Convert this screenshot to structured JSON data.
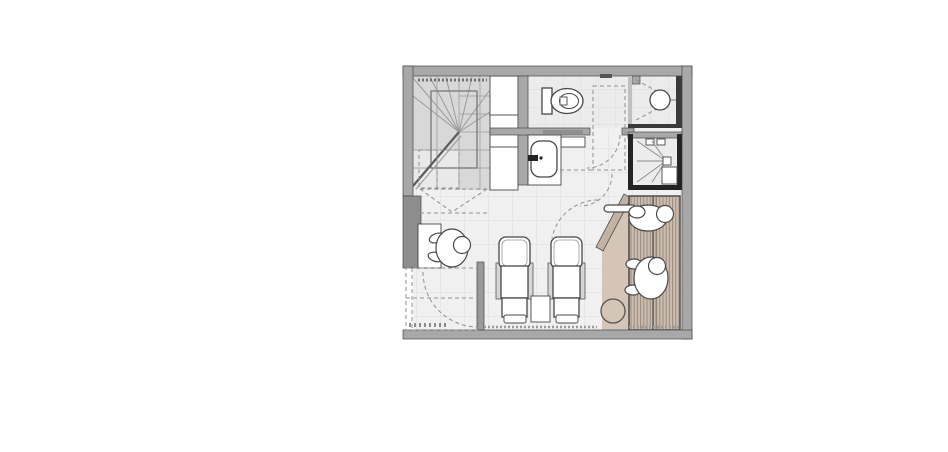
{
  "meta": {
    "document_type": "architectural-floor-plan",
    "view": "top-down plan view",
    "visible_text": ""
  },
  "colors": {
    "canvas": "#ffffff",
    "wall": "#a8a8a8",
    "wall_dark": "#8d8d8d",
    "wall_black": "#242424",
    "outline": "#474747",
    "floor": "#f0f0f0",
    "room_floor": "#ececec",
    "floor_line": "#dcdcdc",
    "stair_fill": "#d8d8d8",
    "stair_light": "#e9e9e9",
    "white": "#ffffff",
    "sauna_floor": "#d4c5b6",
    "sauna_wall": "#c1b2a4",
    "bench": "#ccbdaf",
    "bench_stripe": "#93847a",
    "dashed": "#8f8f8f",
    "fig_line": "#4a4a4a"
  },
  "rooms": [
    {
      "name": "winder-staircase",
      "features": [
        "radiating-treads",
        "stair-well-outline",
        "dashed-hidden-flight",
        "tactile-strip"
      ]
    },
    {
      "name": "wc-room",
      "features": [
        "wall-hung-toilet",
        "door-swing"
      ]
    },
    {
      "name": "shower-room-top",
      "features": [
        "round-drain",
        "dashed-slope-lines"
      ]
    },
    {
      "name": "steam-shower-room",
      "features": [
        "square-drain",
        "slope-lines",
        "corner-bench",
        "niche-squares",
        "dark-walls"
      ]
    },
    {
      "name": "sauna",
      "features": [
        "slatted-wood-benches",
        "diagonal-glass-wall",
        "water-bucket",
        "two-reclining-figures"
      ]
    },
    {
      "name": "treatment-area",
      "features": [
        "two-loungers",
        "side-table",
        "tile-floor"
      ]
    },
    {
      "name": "reception-nook",
      "features": [
        "desk",
        "standing-figure",
        "door-swing"
      ]
    },
    {
      "name": "vestibule",
      "features": [
        "dashed-outline",
        "door-swing",
        "entry-mat"
      ]
    }
  ],
  "fixtures": [
    "toilet",
    "washbasin",
    "vanity-counter",
    "shelf-column",
    "shower-drain-round",
    "shower-drain-square",
    "sauna-bucket",
    "lounger",
    "lounger",
    "side-table",
    "desk"
  ],
  "figures": [
    "person-at-desk",
    "person-reclining-sauna-top",
    "person-reclining-sauna-middle"
  ]
}
